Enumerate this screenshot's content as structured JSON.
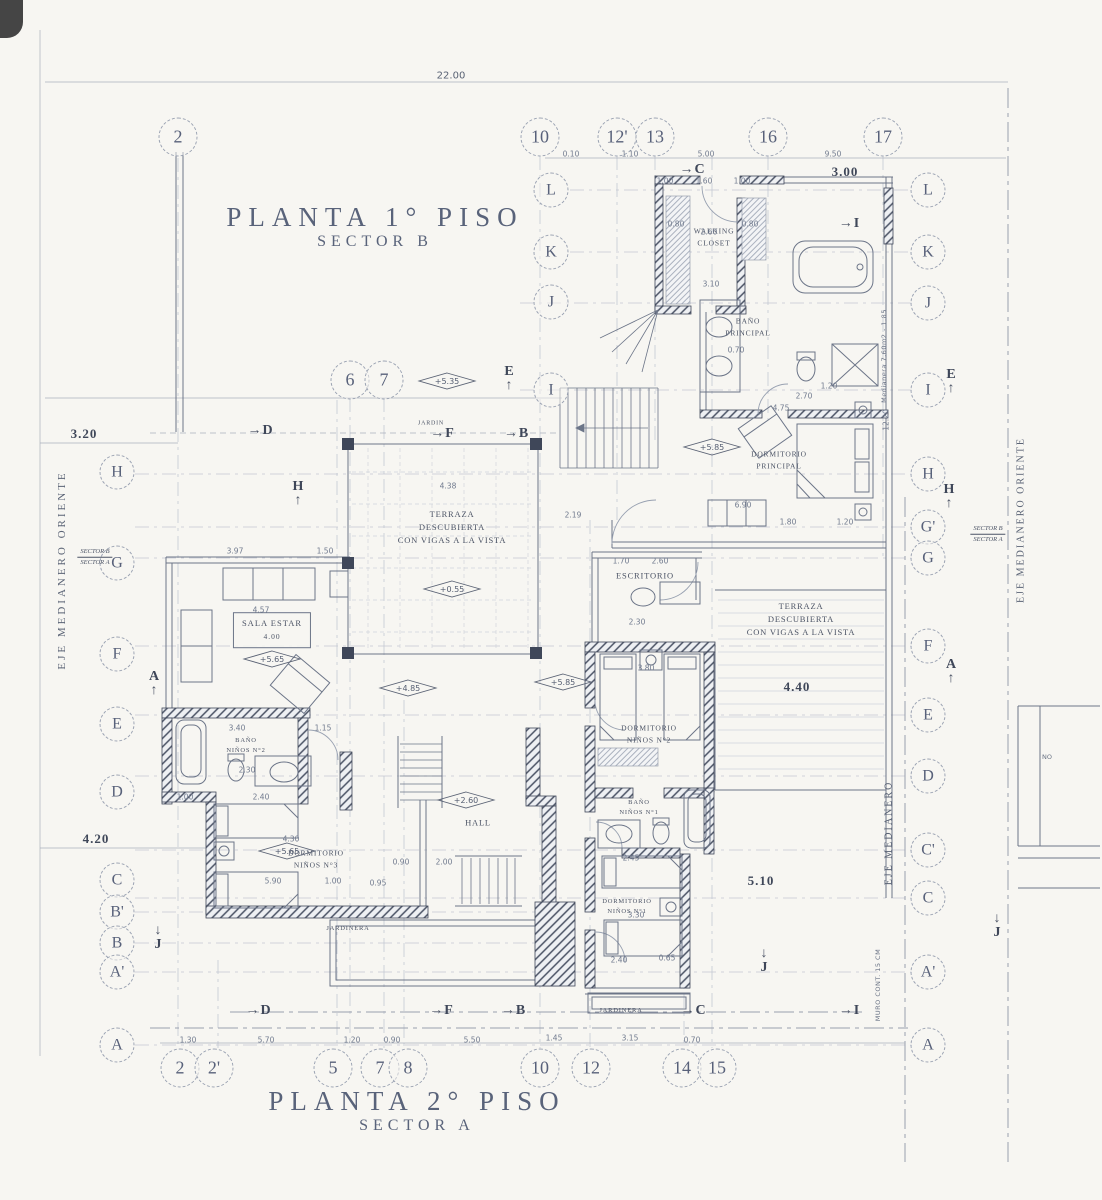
{
  "titles": {
    "plan1_line1": "PLANTA 1° PISO",
    "plan1_line2": "SECTOR B",
    "plan2_line1": "PLANTA 2° PISO",
    "plan2_line2": "SECTOR A"
  },
  "grid": {
    "top": [
      "2",
      "10",
      "12'",
      "13",
      "16",
      "17"
    ],
    "mid": [
      "6",
      "7"
    ],
    "inner_left": [
      "L",
      "K",
      "J",
      "I"
    ],
    "left": [
      "H",
      "G",
      "F",
      "E",
      "D",
      "C",
      "B'",
      "B",
      "A'",
      "A"
    ],
    "right": [
      "L",
      "K",
      "J",
      "I",
      "H",
      "G'",
      "G",
      "F",
      "E",
      "D",
      "C'",
      "C",
      "A'",
      "A"
    ],
    "bottom": [
      "2",
      "2'",
      "5",
      "7",
      "8",
      "10",
      "12",
      "14",
      "15"
    ]
  },
  "rooms": {
    "walking_closet": "WALKING\nCLOSET",
    "bano_principal": "BAÑO\nPRINCIPAL",
    "dormitorio_principal": "DORMITORIO\nPRINCIPAL",
    "escritorio": "ESCRITORIO",
    "terraza_central": "TERRAZA\nDESCUBIERTA\nCON VIGAS A LA VISTA",
    "terraza_derecha": "TERRAZA\nDESCUBIERTA\nCON VIGAS A LA VISTA",
    "sala_estar": "SALA ESTAR",
    "sala_estar_dim": "4.00",
    "dormitorio_ninos2": "DORMITORIO\nNIÑOS N°2",
    "bano_ninos1": "BAÑO\nNIÑOS N°1",
    "dormitorio_ninos1": "DORMITORIO\nNIÑOS N°1",
    "dormitorio_ninos3": "DORMITORIO\nNIÑOS N°3",
    "bano_ninos2": "BAÑO\nNIÑOS N°2",
    "hall": "HALL",
    "jardinera_izq": "JARDINERA",
    "jardinera_inf": "JARDINERA",
    "jardin": "JARDIN"
  },
  "elevations": [
    "+5.35",
    "+5.85",
    "+0.55",
    "+5.65",
    "+4.85",
    "+5.85",
    "+2.60",
    "+5.65"
  ],
  "sections": [
    "C",
    "I",
    "E",
    "E",
    "D",
    "F",
    "B",
    "H",
    "H",
    "A",
    "A",
    "J",
    "J",
    "J",
    "D",
    "F",
    "B",
    "C",
    "I"
  ],
  "dims": [
    "22.00",
    "0.10",
    "1.10",
    "5.00",
    "9.50",
    "3.00",
    "1.00",
    "1.60",
    "1.00",
    "0.80",
    "0.80",
    "2.60",
    "3.10",
    "0.70",
    "1.20",
    "2.70",
    "4.75",
    "1.80",
    "1.20",
    "6.90",
    "2.19",
    "1.70",
    "2.60",
    "2.30",
    "3.80",
    "4.40",
    "3.40",
    "1.15",
    "2.30",
    "2.40",
    "1.00",
    "4.30",
    "5.90",
    "1.00",
    "0.95",
    "0.90",
    "2.00",
    "2.45",
    "3.30",
    "2.40",
    "0.65",
    "5.10",
    "3.20",
    "4.20",
    "1.30",
    "5.70",
    "1.20",
    "0.90",
    "5.50",
    "1.45",
    "3.15",
    "0.70",
    "3.97",
    "1.50",
    "4.38",
    "4.57",
    "12.20"
  ],
  "axes": {
    "left": "EJE MEDIANERO ORIENTE",
    "right_inner": "EJE MEDIANERO",
    "right_outer": "EJE MEDIANERO ORIENTE"
  },
  "notes": {
    "sector_b": "SECTOR B",
    "sector_a": "SECTOR A",
    "medianera": "Medianera 7,60m2 - 1.85",
    "muro": "MURO CONT. 15 CM",
    "adjacent": "NO"
  }
}
